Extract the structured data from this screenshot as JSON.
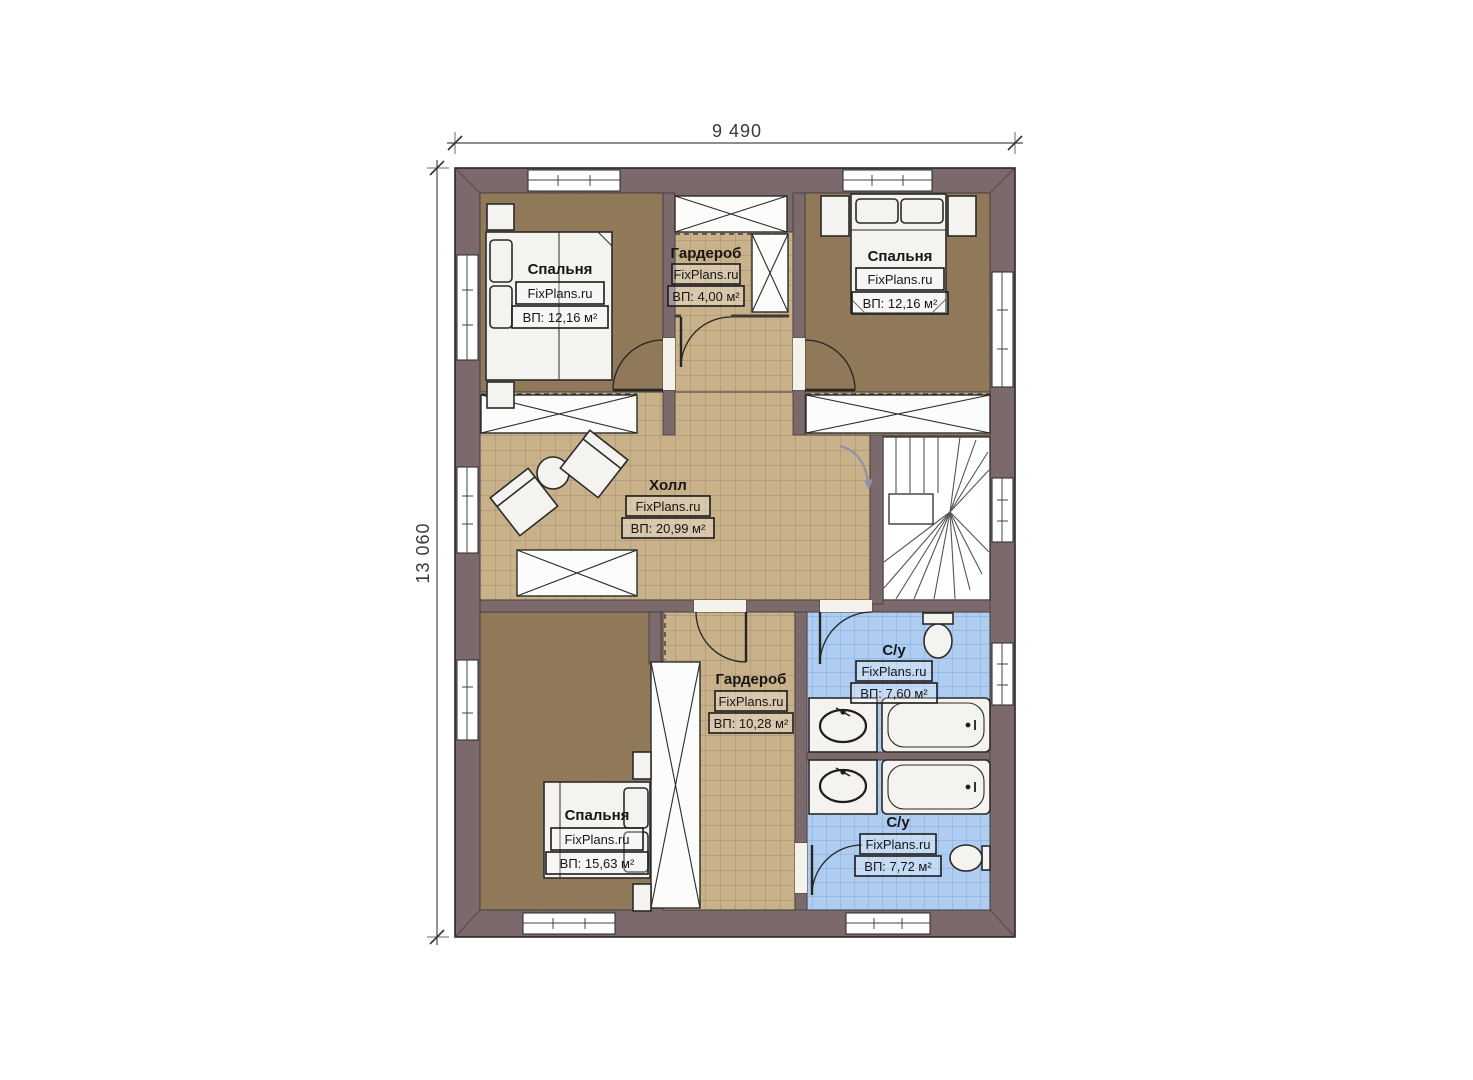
{
  "plan": {
    "brand": "FixPlans.ru",
    "dimensions": {
      "width": "9 490",
      "height": "13 060"
    },
    "rooms": [
      {
        "key": "bedroom-top-left",
        "name": "Спальня",
        "area": "ВП: 12,16 м²"
      },
      {
        "key": "wardrobe-top",
        "name": "Гардероб",
        "area": "ВП: 4,00 м²"
      },
      {
        "key": "bedroom-top-right",
        "name": "Спальня",
        "area": "ВП: 12,16 м²"
      },
      {
        "key": "hall",
        "name": "Холл",
        "area": "ВП: 20,99 м²"
      },
      {
        "key": "bathroom-top",
        "name": "С/у",
        "area": "ВП: 7,60 м²"
      },
      {
        "key": "bedroom-bottom",
        "name": "Спальня",
        "area": "ВП: 15,63 м²"
      },
      {
        "key": "wardrobe-bottom",
        "name": "Гардероб",
        "area": "ВП: 10,28 м²"
      },
      {
        "key": "bathroom-bottom",
        "name": "С/у",
        "area": "ВП: 7,72 м²"
      }
    ],
    "colors": {
      "wall": "#7c696c",
      "bedroom_floor": "#937b5c",
      "tile_floor": "#c9b189",
      "bathroom_floor": "#aecdf1"
    }
  }
}
